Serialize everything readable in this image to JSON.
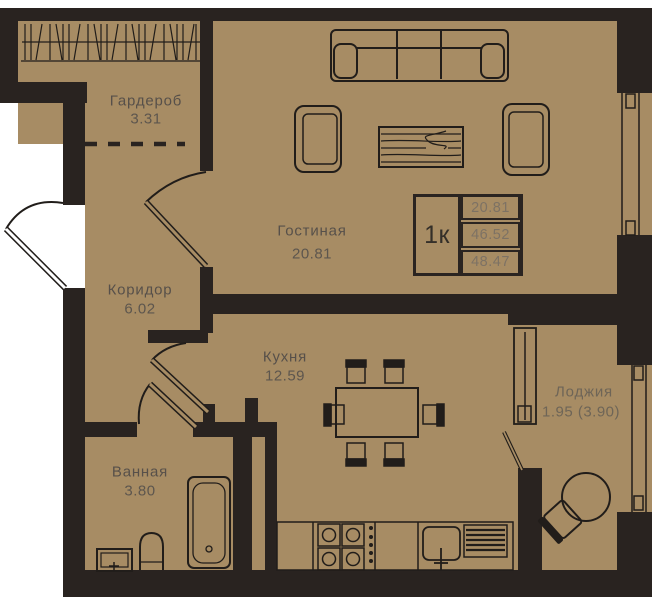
{
  "plan_type": "apartment-floor-plan",
  "rooms": {
    "wardrobe": {
      "name": "Гардероб",
      "area": "3.31"
    },
    "corridor": {
      "name": "Коридор",
      "area": "6.02"
    },
    "living": {
      "name": "Гостиная",
      "area": "20.81"
    },
    "kitchen": {
      "name": "Кухня",
      "area": "12.59"
    },
    "bathroom": {
      "name": "Ванная",
      "area": "3.80"
    },
    "loggia": {
      "name": "Лоджия",
      "area": "1.95 (3.90)"
    }
  },
  "info_box": {
    "unit_type": "1к",
    "values": [
      "20.81",
      "46.52",
      "48.47"
    ]
  },
  "icons": [
    "sofa-icon",
    "armchair-icon",
    "coffee-table-icon",
    "dining-table-icon",
    "chair-icon",
    "stove-icon",
    "kitchen-sink-icon",
    "dishwasher-icon",
    "bathtub-icon",
    "toilet-icon",
    "washbasin-icon",
    "round-table-icon",
    "wardrobe-rail-icon",
    "door-icon",
    "window-icon"
  ],
  "colors": {
    "background": "#ffffff",
    "floor": "#a78c64",
    "wall": "#292320",
    "line": "#211d1a",
    "label": "#57504a",
    "info_value": "#7d7264"
  }
}
